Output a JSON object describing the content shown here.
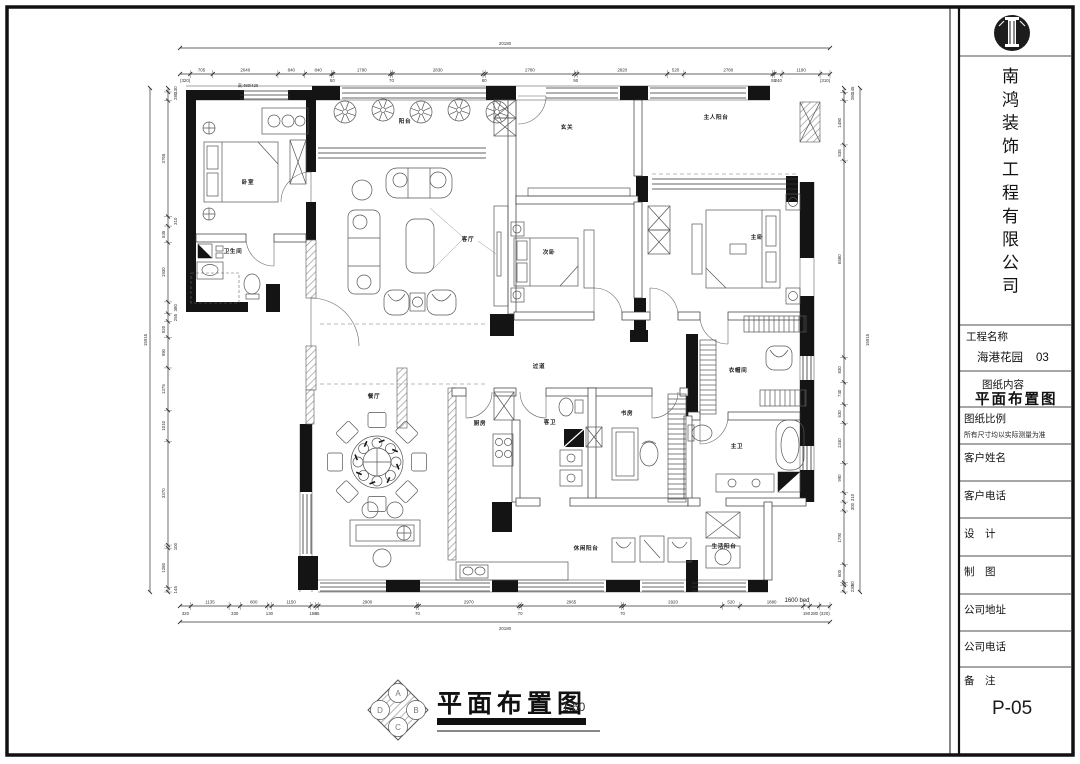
{
  "colors": {
    "paper": "#ffffff",
    "ink": "#141414"
  },
  "sheet": {
    "logo": "pillar-logo",
    "company_name": "南鸿装饰工程有限公司",
    "fields": [
      {
        "label": "工程名称",
        "value": "海港花园",
        "code": "03"
      },
      {
        "label": "图纸内容",
        "value": "平面布置图"
      },
      {
        "label": "图纸比例",
        "value": "所有尺寸均以实际测量为准"
      },
      {
        "label": "客户姓名",
        "value": ""
      },
      {
        "label": "客户电话",
        "value": ""
      },
      {
        "label": "设　计",
        "value": ""
      },
      {
        "label": "制　图",
        "value": ""
      },
      {
        "label": "公司地址",
        "value": ""
      },
      {
        "label": "公司电话",
        "value": ""
      },
      {
        "label": "备　注",
        "value": "P-05"
      }
    ]
  },
  "drawing_title": {
    "text": "平面布置图",
    "scale": "1:60",
    "stamp": [
      "A",
      "B",
      "C",
      "D"
    ]
  },
  "plan": {
    "rooms": [
      {
        "name": "卧室",
        "x": 248,
        "y": 184
      },
      {
        "name": "卫生间",
        "x": 233,
        "y": 253
      },
      {
        "name": "阳台",
        "x": 405,
        "y": 123
      },
      {
        "name": "客厅",
        "x": 468,
        "y": 241
      },
      {
        "name": "玄关",
        "x": 567,
        "y": 129
      },
      {
        "name": "次卧",
        "x": 549,
        "y": 254
      },
      {
        "name": "主人阳台",
        "x": 716,
        "y": 119
      },
      {
        "name": "主卧",
        "x": 757,
        "y": 239
      },
      {
        "name": "餐厅",
        "x": 374,
        "y": 398
      },
      {
        "name": "厨房",
        "x": 480,
        "y": 425
      },
      {
        "name": "过道",
        "x": 539,
        "y": 368
      },
      {
        "name": "客卫",
        "x": 550,
        "y": 424
      },
      {
        "name": "书房",
        "x": 627,
        "y": 415
      },
      {
        "name": "衣帽间",
        "x": 738,
        "y": 372
      },
      {
        "name": "主卫",
        "x": 737,
        "y": 448
      },
      {
        "name": "休闲阳台",
        "x": 586,
        "y": 550
      },
      {
        "name": "生活阳台",
        "x": 724,
        "y": 548
      }
    ],
    "annotations": [
      {
        "text": "高:480/420",
        "x": 248,
        "y": 87,
        "fs": 4.2,
        "color": "#444"
      },
      {
        "text": "1600 bed",
        "x": 797,
        "y": 602,
        "fs": 6,
        "color": "#c0c0c0"
      }
    ],
    "dimensions": {
      "top": {
        "total": "20180",
        "segments": [
          "(320)",
          "705",
          "2040",
          "840",
          "840",
          "50",
          "1790",
          "70",
          "2830",
          "80",
          "2780",
          "90",
          "2820",
          "520",
          "2780",
          "55",
          "240",
          "1190",
          "(310)"
        ]
      },
      "bottom": {
        "total": "20180",
        "segments": [
          "320",
          "1135",
          "330",
          "800",
          "130",
          "1150",
          "150",
          "85",
          "2900",
          "70",
          "2970",
          "70",
          "2965",
          "70",
          "2920",
          "520",
          "1880",
          "190",
          "280",
          "(320)"
        ]
      },
      "left": {
        "total": "15915",
        "segments": [
          "130",
          "280",
          "3765",
          "310",
          "535",
          "1930",
          "380",
          "255",
          "520",
          "990",
          "1375",
          "1010",
          "3370",
          "100",
          "1280",
          "145"
        ]
      },
      "right": {
        "total": "15915",
        "segments": [
          "145",
          "280",
          "1480",
          "535",
          "6580",
          "830",
          "740",
          "630",
          "1340",
          "990",
          "310",
          "300",
          "1790",
          "600",
          "90",
          "230"
        ]
      }
    }
  }
}
